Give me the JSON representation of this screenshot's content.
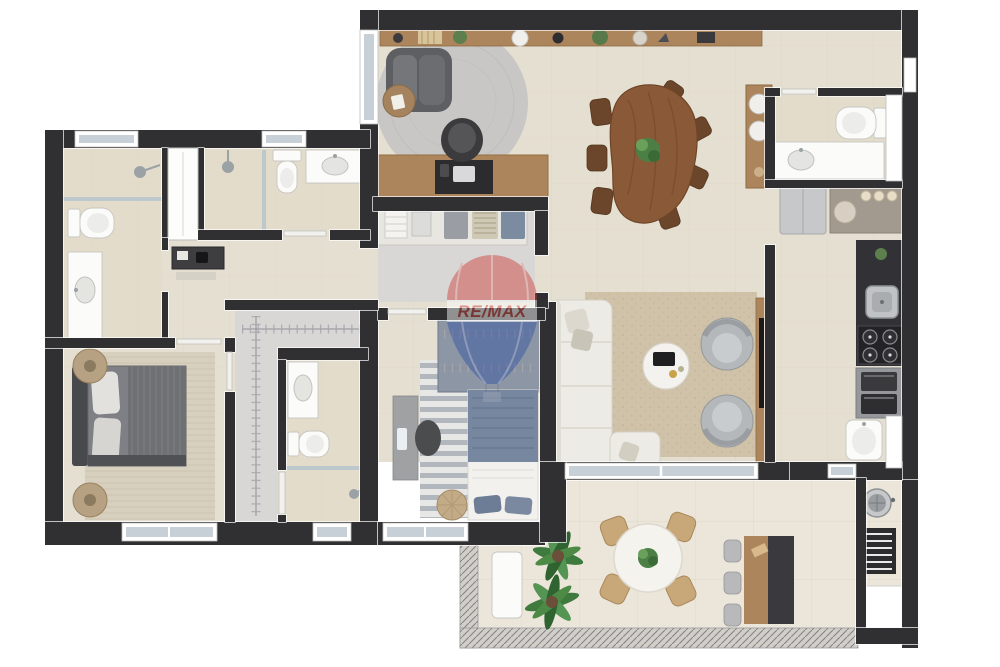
{
  "scene": {
    "type": "3d-floor-plan-top-view",
    "description": "Rendered apartment floor plan, no room labels, white background",
    "background": "#ffffff"
  },
  "watermark": {
    "brand": "RE/MAX",
    "icon": "hot-air-balloon-logo",
    "red": "#cc4038",
    "blue": "#3553a5"
  },
  "colors": {
    "wall": "#303032",
    "floor": "#e5dfd2",
    "floorBath": "#e4dccb",
    "floorCloset": "#d8d7d6",
    "floorTerrace": "#ebe6d9",
    "tile": "#d9d2c3",
    "wood": "#ad855c",
    "woodDark": "#8a5a38",
    "chairWood": "#6b462a",
    "glass": "#b9c6cb",
    "windowGlass": "#c6d0d6",
    "sofa": "#edebe5",
    "rugLiving": "#c8c7c5",
    "rugFamily": "#cfc2a8",
    "rugMaster": "#d8d0bf",
    "darkFurn": "#3a3a3d",
    "grayFurn": "#b5b8bb",
    "bedMaster": "#7e8085",
    "bedBlue": "#76879f",
    "wardrobeBlue": "#8c96a4",
    "counterGray": "#a29a8e",
    "steel": "#c0c3c6",
    "green": "#4c7f46",
    "remaxRed": "#cc4038",
    "remaxBlue": "#3553a5"
  },
  "rooms": [
    {
      "id": "living-room",
      "furniture": [
        "wall-shelf-with-decor",
        "dark-armchair",
        "round-side-table",
        "round-gray-rug",
        "wood-desk",
        "desk-chair",
        "laptop"
      ]
    },
    {
      "id": "dining-room",
      "furniture": [
        "organic-wood-dining-table",
        "seven-wood-chairs",
        "plant-centerpiece",
        "tall-sideboard-with-plates"
      ]
    },
    {
      "id": "family-room",
      "furniture": [
        "white-l-sofa",
        "throw-pillows",
        "beige-area-rug",
        "round-coffee-table",
        "two-round-armchairs",
        "wood-tv-panel"
      ]
    },
    {
      "id": "bathroom-top-right",
      "furniture": [
        "toilet",
        "vanity-sink",
        "window"
      ]
    },
    {
      "id": "kitchen-service",
      "furniture": [
        "refrigerator",
        "counter-with-jars",
        "dark-counter",
        "steel-sink",
        "four-burner-cooktop",
        "oven-microwave-stack",
        "laundry-sink",
        "window"
      ]
    },
    {
      "id": "closet-room",
      "furniture": [
        "counter-with-folded-clothes"
      ]
    },
    {
      "id": "bedroom-2",
      "furniture": [
        "wardrobe-with-hangers",
        "single-bed-blue",
        "wall-desk",
        "desk-chair",
        "striped-rug",
        "round-pouf",
        "window"
      ]
    },
    {
      "id": "bathroom-left",
      "furniture": [
        "shower",
        "glass-partition",
        "toilet",
        "long-vanity",
        "window"
      ]
    },
    {
      "id": "bathroom-middle",
      "furniture": [
        "shower-stall",
        "white-cabinet",
        "toilet",
        "vanity-sink"
      ]
    },
    {
      "id": "hallway",
      "furniture": [
        "console-table"
      ]
    },
    {
      "id": "master-bedroom",
      "furniture": [
        "double-bed-gray",
        "two-round-nightstands",
        "textured-rug",
        "windows"
      ]
    },
    {
      "id": "walk-in-closet",
      "furniture": [
        "hanging-rails"
      ]
    },
    {
      "id": "bathroom-ensuite",
      "furniture": [
        "vanity-sink",
        "toilet",
        "shower",
        "window"
      ]
    },
    {
      "id": "terrace",
      "furniture": [
        "glass-railing",
        "white-bench",
        "two-palm-plants",
        "round-dining-table",
        "four-wood-armchairs",
        "plant-centerpiece",
        "bar-table",
        "three-gray-chairs",
        "round-barbecue-grill",
        "slatted-grill-counter",
        "white-counter-box"
      ]
    }
  ]
}
